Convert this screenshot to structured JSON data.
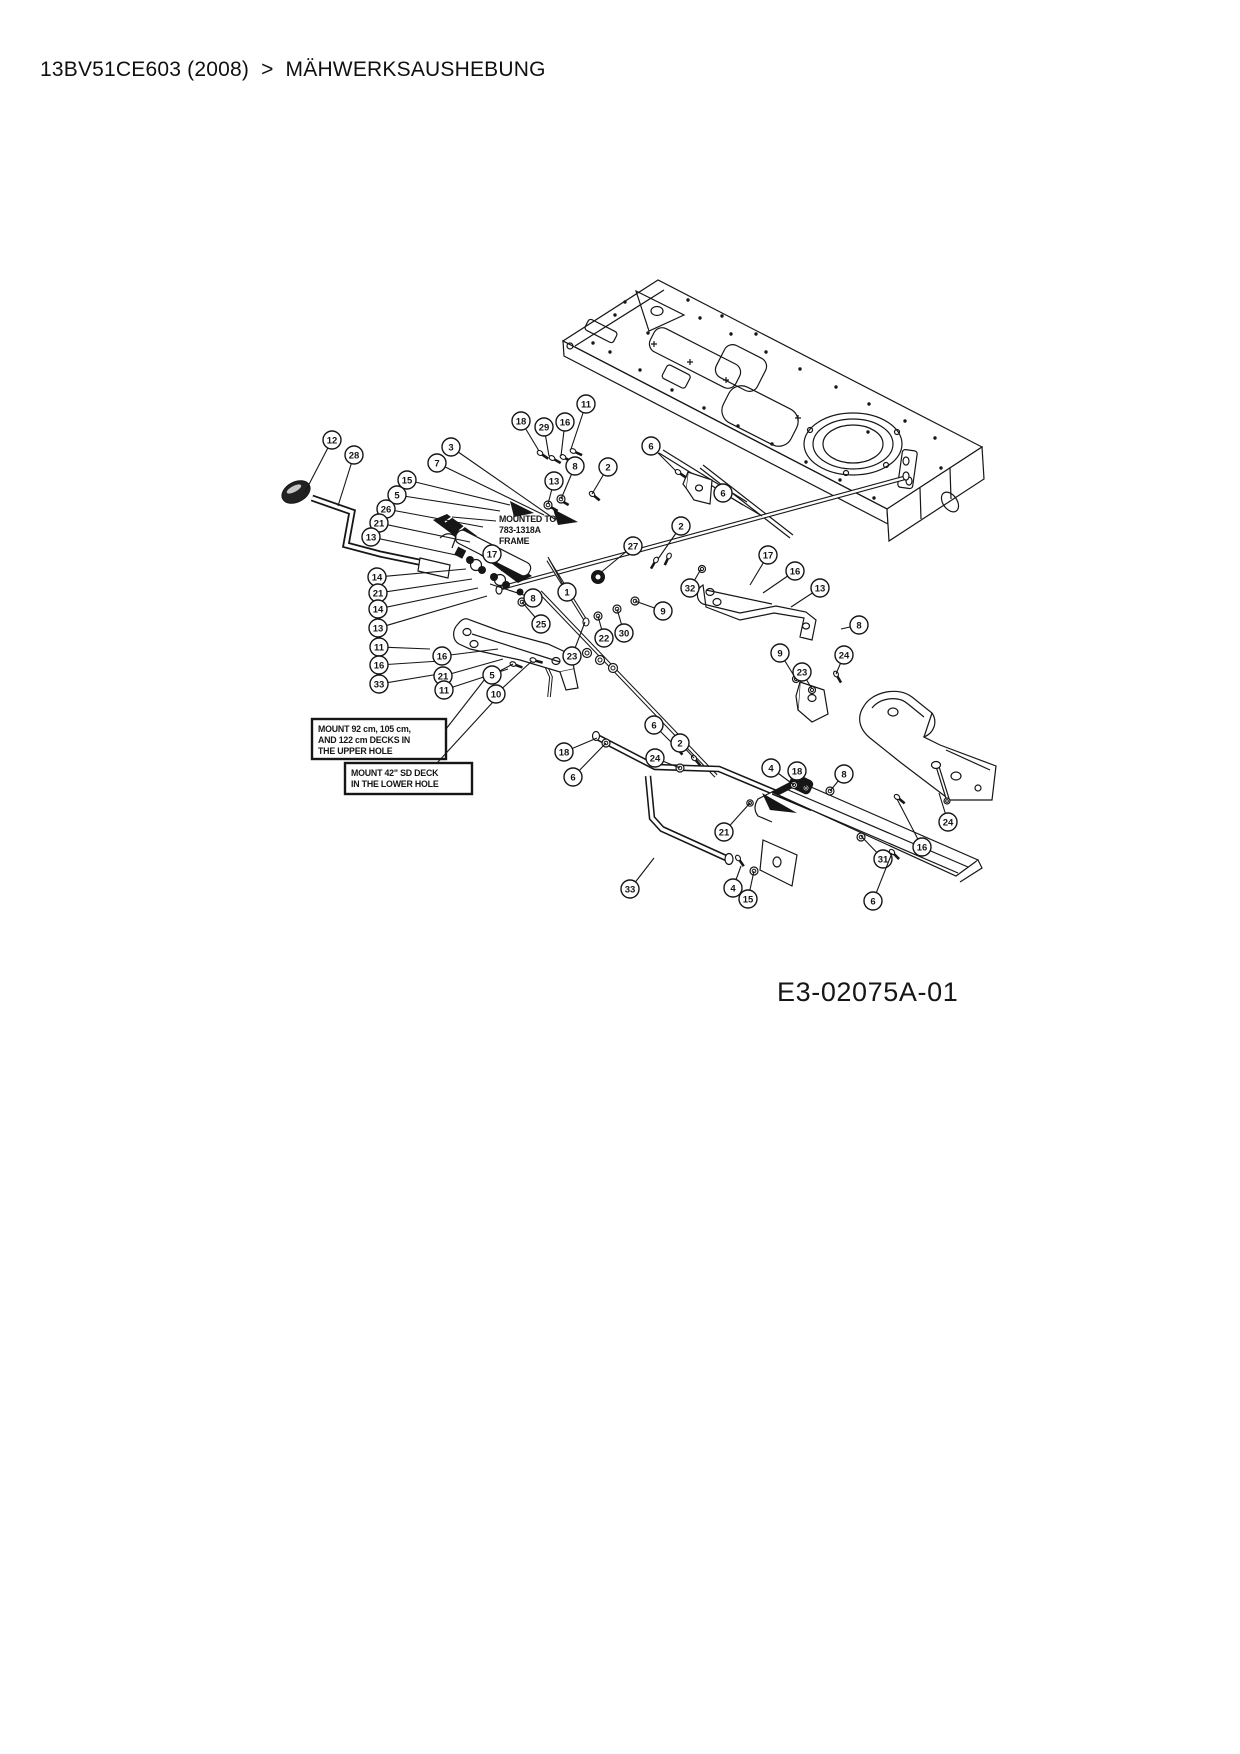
{
  "breadcrumb": {
    "model": "13BV51CE603 (2008)",
    "separator": ">",
    "section": "MÄHWERKSAUSHEBUNG"
  },
  "diagram": {
    "figure_label": "E3-02075A-01",
    "ink_color": "#161616",
    "notes": [
      {
        "id": "mounted-to-frame-note",
        "boxed": false,
        "x": 499,
        "y": 514,
        "w": 70,
        "h": 36,
        "lines": [
          "MOUNTED TO",
          "783-1318A",
          "FRAME"
        ],
        "leader": [
          496,
          521,
          452,
          517
        ]
      },
      {
        "id": "upper-hole-note",
        "boxed": true,
        "x": 318,
        "y": 724,
        "w": 134,
        "h": 40,
        "lines": [
          "MOUNT 92 cm, 105 cm,",
          "AND 122 cm DECKS IN",
          "THE UPPER HOLE"
        ],
        "leader": [
          446,
          729,
          492,
          670
        ]
      },
      {
        "id": "lower-hole-note",
        "boxed": true,
        "x": 351,
        "y": 768,
        "w": 127,
        "h": 31,
        "lines": [
          "MOUNT 42\" SD DECK",
          "IN THE LOWER HOLE"
        ],
        "leader": [
          437,
          763,
          504,
          690
        ]
      }
    ],
    "callouts": [
      {
        "n": "12",
        "x": 332,
        "y": 440,
        "tx": 305,
        "ty": 492
      },
      {
        "n": "28",
        "x": 354,
        "y": 455,
        "tx": 338,
        "ty": 506
      },
      {
        "n": "3",
        "x": 451,
        "y": 447,
        "tx": 556,
        "ty": 520
      },
      {
        "n": "7",
        "x": 437,
        "y": 463,
        "tx": 544,
        "ty": 515
      },
      {
        "n": "15",
        "x": 407,
        "y": 480,
        "tx": 510,
        "ty": 505
      },
      {
        "n": "5",
        "x": 397,
        "y": 495,
        "tx": 500,
        "ty": 511
      },
      {
        "n": "26",
        "x": 386,
        "y": 509,
        "tx": 483,
        "ty": 527
      },
      {
        "n": "21",
        "x": 379,
        "y": 523,
        "tx": 470,
        "ty": 542
      },
      {
        "n": "13",
        "x": 371,
        "y": 537,
        "tx": 456,
        "ty": 555
      },
      {
        "n": "14",
        "x": 377,
        "y": 577,
        "tx": 466,
        "ty": 569
      },
      {
        "n": "21",
        "x": 378,
        "y": 593,
        "tx": 472,
        "ty": 579
      },
      {
        "n": "14",
        "x": 378,
        "y": 609,
        "tx": 478,
        "ty": 588
      },
      {
        "n": "13",
        "x": 378,
        "y": 628,
        "tx": 487,
        "ty": 596
      },
      {
        "n": "11",
        "x": 379,
        "y": 647,
        "tx": 430,
        "ty": 649
      },
      {
        "n": "16",
        "x": 379,
        "y": 665,
        "tx": 440,
        "ty": 661
      },
      {
        "n": "33",
        "x": 379,
        "y": 684,
        "tx": 451,
        "ty": 672
      },
      {
        "n": "18",
        "x": 521,
        "y": 421,
        "tx": 539,
        "ty": 451
      },
      {
        "n": "29",
        "x": 544,
        "y": 427,
        "tx": 549,
        "ty": 456
      },
      {
        "n": "16",
        "x": 565,
        "y": 422,
        "tx": 561,
        "ty": 456
      },
      {
        "n": "11",
        "x": 586,
        "y": 404,
        "tx": 571,
        "ty": 449
      },
      {
        "n": "8",
        "x": 575,
        "y": 466,
        "tx": 561,
        "ty": 499
      },
      {
        "n": "13",
        "x": 554,
        "y": 481,
        "tx": 548,
        "ty": 504
      },
      {
        "n": "2",
        "x": 608,
        "y": 467,
        "tx": 592,
        "ty": 494
      },
      {
        "n": "6",
        "x": 651,
        "y": 446,
        "tx": 676,
        "ty": 471
      },
      {
        "n": "17",
        "x": 492,
        "y": 554,
        "tx": 502,
        "ty": 571
      },
      {
        "n": "8",
        "x": 533,
        "y": 598,
        "tx": 490,
        "ty": 584
      },
      {
        "n": "1",
        "x": 567,
        "y": 592,
        "tx": 548,
        "ty": 557
      },
      {
        "n": "27",
        "x": 633,
        "y": 546,
        "tx": 599,
        "ty": 574
      },
      {
        "n": "9",
        "x": 663,
        "y": 611,
        "tx": 635,
        "ty": 601
      },
      {
        "n": "30",
        "x": 624,
        "y": 633,
        "tx": 617,
        "ty": 609
      },
      {
        "n": "22",
        "x": 604,
        "y": 638,
        "tx": 598,
        "ty": 616
      },
      {
        "n": "23",
        "x": 572,
        "y": 656,
        "tx": 585,
        "ty": 622
      },
      {
        "n": "25",
        "x": 541,
        "y": 624,
        "tx": 522,
        "ty": 602
      },
      {
        "n": "16",
        "x": 442,
        "y": 656,
        "tx": 498,
        "ty": 649
      },
      {
        "n": "21",
        "x": 443,
        "y": 676,
        "tx": 503,
        "ty": 659
      },
      {
        "n": "11",
        "x": 444,
        "y": 690,
        "tx": 508,
        "ty": 669
      },
      {
        "n": "5",
        "x": 492,
        "y": 675,
        "tx": 513,
        "ty": 664
      },
      {
        "n": "10",
        "x": 496,
        "y": 694,
        "tx": 532,
        "ty": 661
      },
      {
        "n": "2",
        "x": 681,
        "y": 526,
        "tx": 658,
        "ty": 559
      },
      {
        "n": "32",
        "x": 690,
        "y": 588,
        "tx": 701,
        "ty": 569
      },
      {
        "n": "6",
        "x": 723,
        "y": 493,
        "tx": 762,
        "ty": 516
      },
      {
        "n": "17",
        "x": 768,
        "y": 555,
        "tx": 750,
        "ty": 585
      },
      {
        "n": "16",
        "x": 795,
        "y": 571,
        "tx": 763,
        "ty": 593
      },
      {
        "n": "13",
        "x": 820,
        "y": 588,
        "tx": 791,
        "ty": 607
      },
      {
        "n": "8",
        "x": 859,
        "y": 625,
        "tx": 841,
        "ty": 629
      },
      {
        "n": "24",
        "x": 844,
        "y": 655,
        "tx": 836,
        "ty": 674
      },
      {
        "n": "9",
        "x": 780,
        "y": 653,
        "tx": 796,
        "ty": 679
      },
      {
        "n": "23",
        "x": 802,
        "y": 672,
        "tx": 812,
        "ty": 689
      },
      {
        "n": "18",
        "x": 564,
        "y": 752,
        "tx": 597,
        "ty": 738
      },
      {
        "n": "6",
        "x": 573,
        "y": 777,
        "tx": 606,
        "ty": 743
      },
      {
        "n": "6",
        "x": 654,
        "y": 725,
        "tx": 676,
        "ty": 747
      },
      {
        "n": "2",
        "x": 680,
        "y": 743,
        "tx": 694,
        "ty": 758
      },
      {
        "n": "24",
        "x": 655,
        "y": 758,
        "tx": 680,
        "ty": 768
      },
      {
        "n": "4",
        "x": 771,
        "y": 768,
        "tx": 794,
        "ty": 785
      },
      {
        "n": "18",
        "x": 797,
        "y": 771,
        "tx": 806,
        "ty": 787
      },
      {
        "n": "8",
        "x": 844,
        "y": 774,
        "tx": 830,
        "ty": 791
      },
      {
        "n": "33",
        "x": 630,
        "y": 889,
        "tx": 654,
        "ty": 858
      },
      {
        "n": "4",
        "x": 733,
        "y": 888,
        "tx": 741,
        "ty": 866
      },
      {
        "n": "15",
        "x": 748,
        "y": 899,
        "tx": 754,
        "ty": 871
      },
      {
        "n": "21",
        "x": 724,
        "y": 832,
        "tx": 750,
        "ty": 803
      },
      {
        "n": "31",
        "x": 883,
        "y": 859,
        "tx": 861,
        "ty": 836
      },
      {
        "n": "16",
        "x": 922,
        "y": 847,
        "tx": 897,
        "ty": 799
      },
      {
        "n": "24",
        "x": 948,
        "y": 822,
        "tx": 939,
        "ty": 793
      },
      {
        "n": "6",
        "x": 873,
        "y": 901,
        "tx": 892,
        "ty": 853
      }
    ]
  }
}
